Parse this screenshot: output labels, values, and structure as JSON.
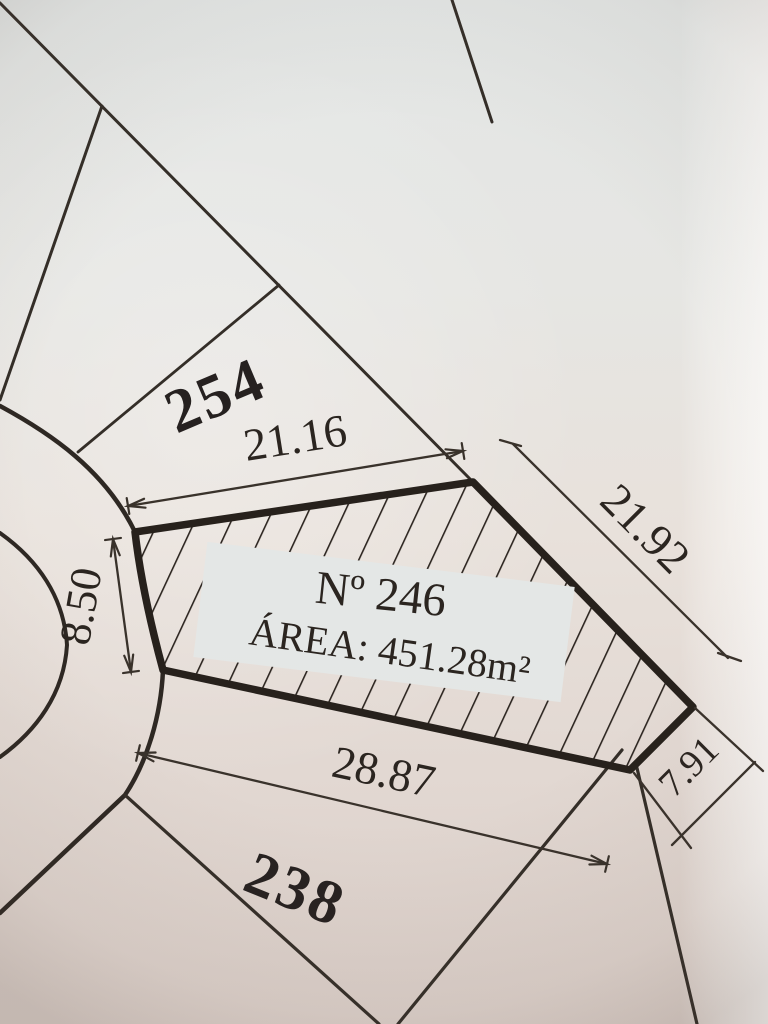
{
  "plan": {
    "main_lot": {
      "number": "Nº 246",
      "area": "ÁREA: 451.28m²"
    },
    "adjacent_lots": {
      "upper_left": "254",
      "lower": "238"
    },
    "dimensions": {
      "top_edge": "21.16",
      "right_edge": "21.92",
      "left_edge": "8.50",
      "bottom_edge": "28.87",
      "corner_edge": "7.91"
    },
    "colors": {
      "ink": "#342e28",
      "lot_outline": "#27211c",
      "paper_top": "#e4e7e6",
      "paper_middle": "#e8e1db",
      "paper_bottom": "#dbcfc9",
      "paper_edge_highlight": "#f2f0ed"
    }
  }
}
